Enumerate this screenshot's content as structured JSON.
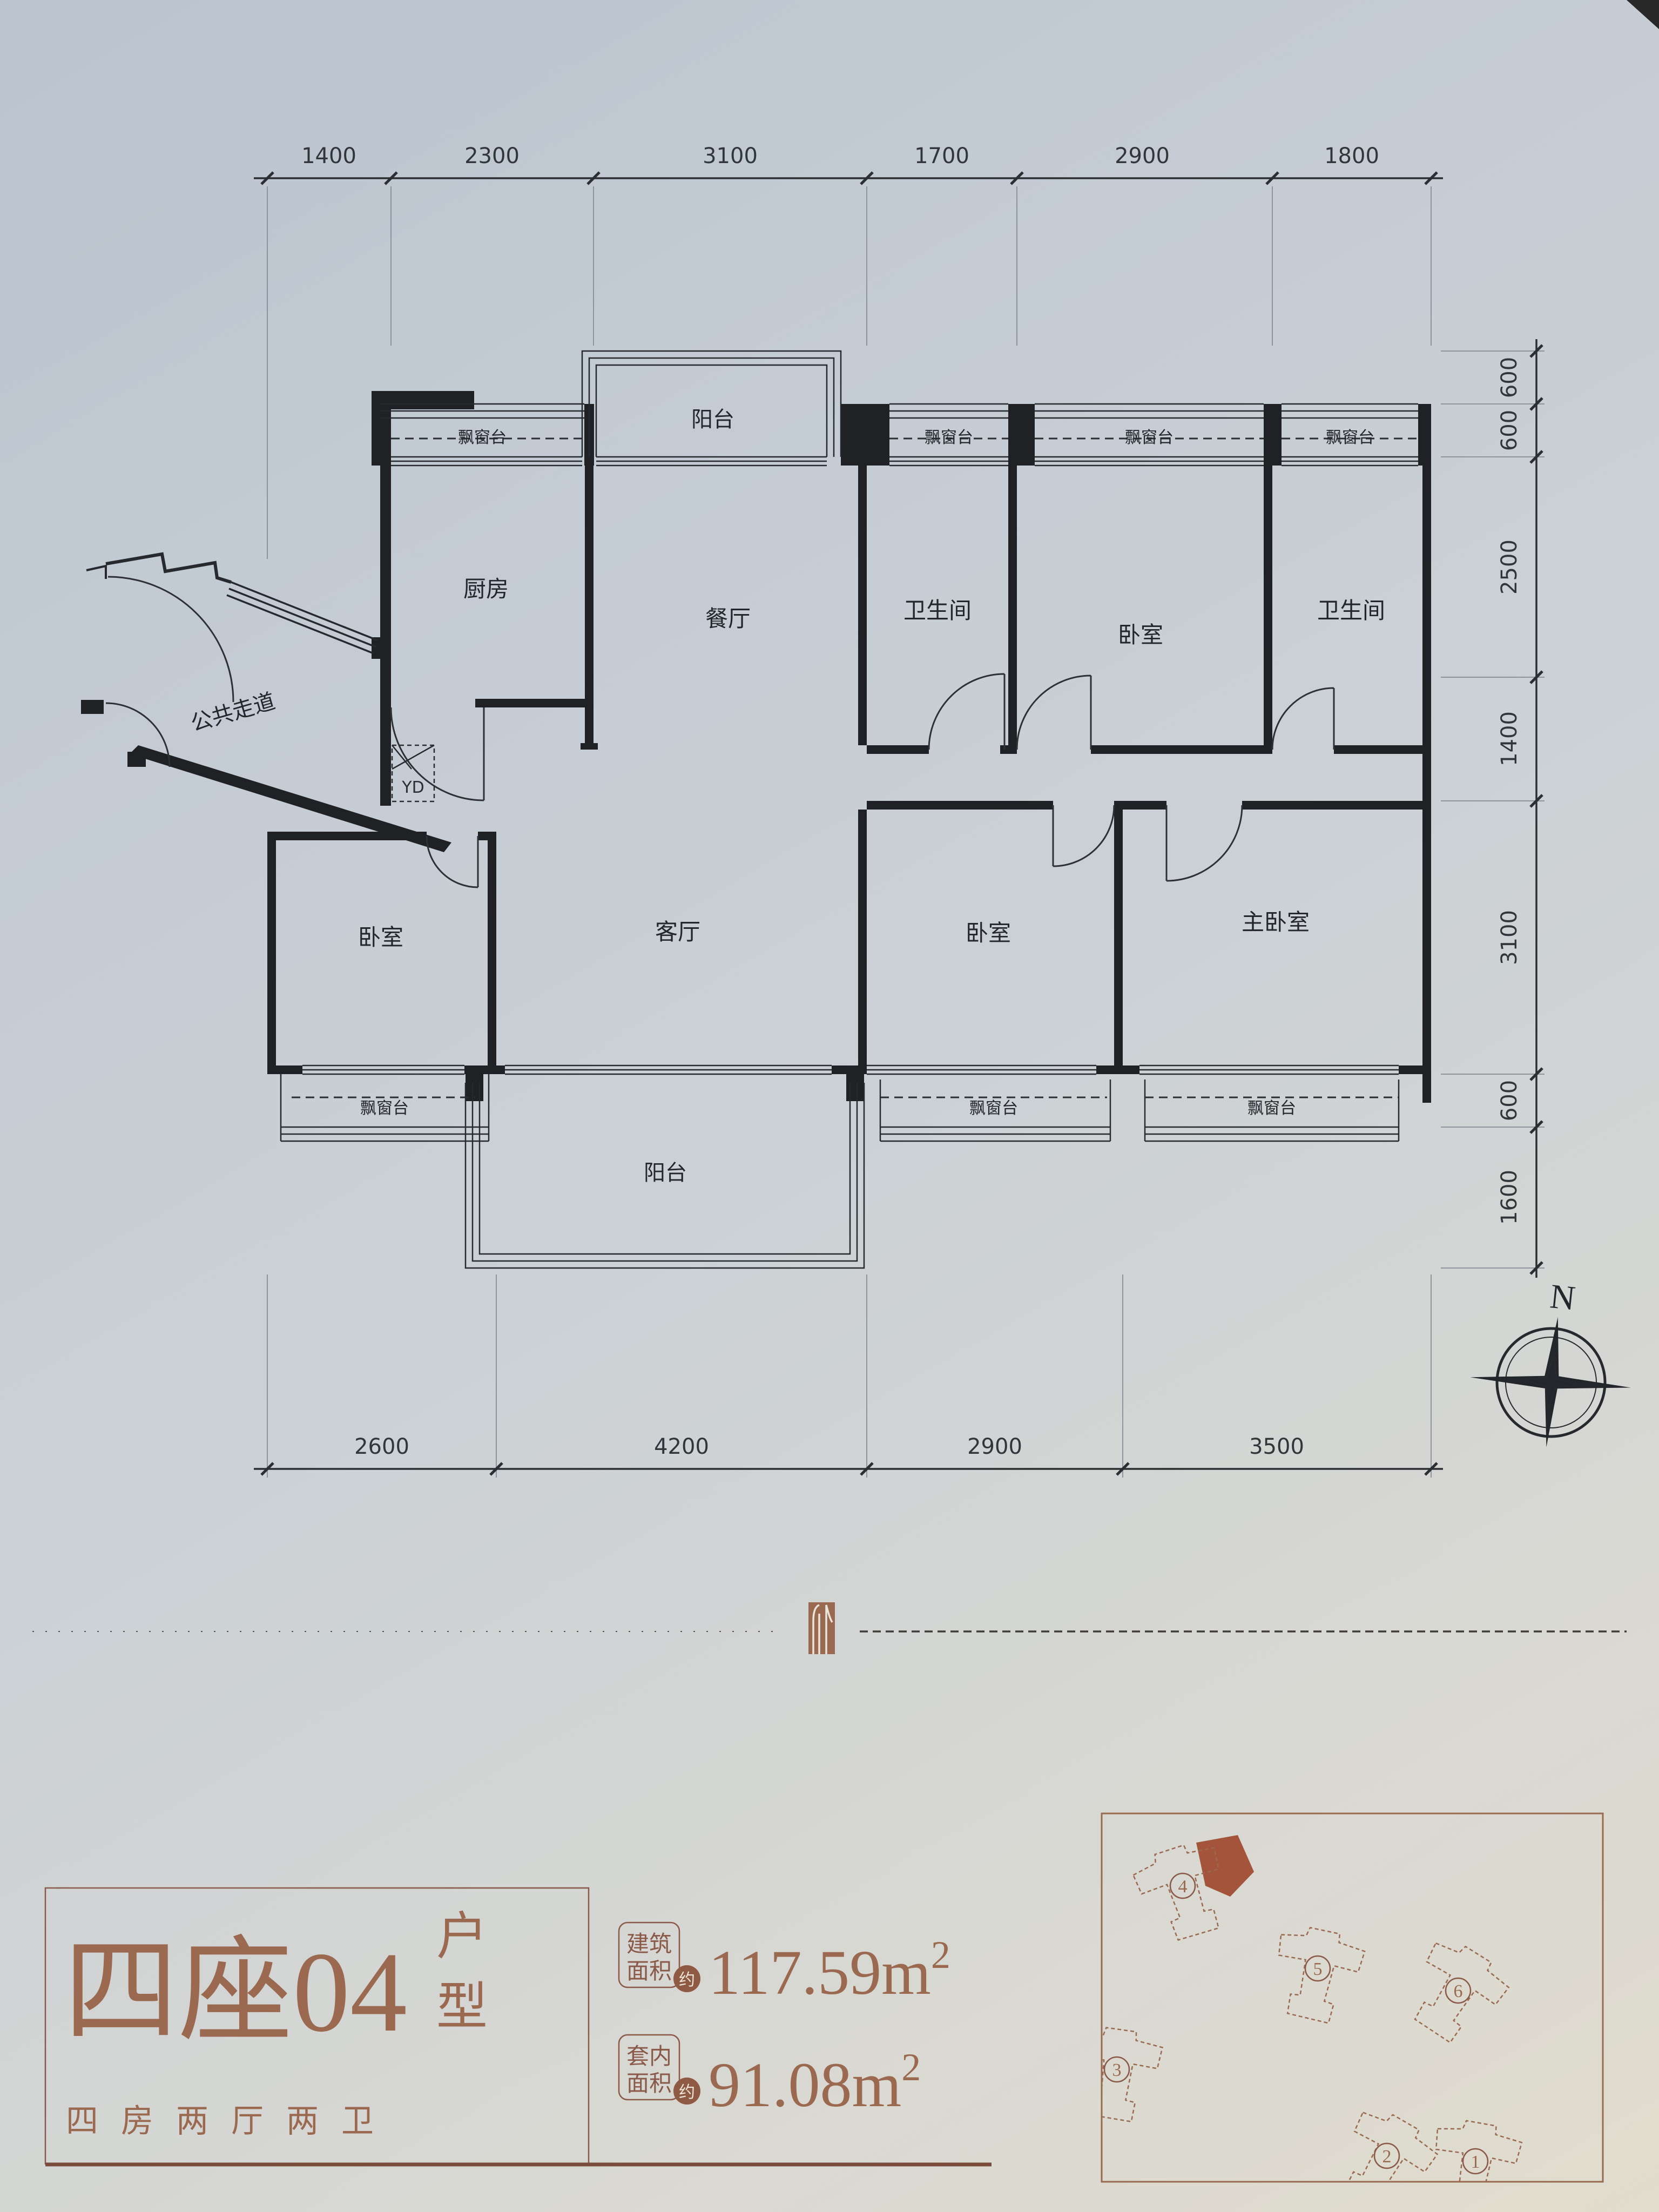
{
  "dims": {
    "top": [
      "1400",
      "2300",
      "3100",
      "1700",
      "2900",
      "1800"
    ],
    "right": [
      "600",
      "600",
      "2500",
      "1400",
      "3100",
      "600",
      "1600"
    ],
    "bottom": [
      "2600",
      "4200",
      "2900",
      "3500"
    ]
  },
  "rooms": {
    "kitchen": "厨房",
    "dining": "餐厅",
    "bath": "卫生间",
    "bedroom": "卧室",
    "master": "主卧室",
    "living": "客厅",
    "corridor": "公共走道",
    "balcony": "阳台",
    "bay_window": "飘窗台",
    "meter_box": "YD"
  },
  "compass": {
    "north": "N"
  },
  "title": {
    "main": "四座04",
    "suffix_top": "户",
    "suffix_bottom": "型",
    "subtitle": "四房两厅两卫"
  },
  "areas": {
    "label1_line1": "建筑",
    "label1_line2": "面积",
    "label2_line1": "套内",
    "label2_line2": "面积",
    "approx": "约",
    "value1": "117.59",
    "value2": "91.08",
    "unit": "m",
    "sup": "2"
  },
  "site": {
    "b1": "1",
    "b2": "2",
    "b3": "3",
    "b4": "4",
    "b5": "5",
    "b6": "6"
  }
}
